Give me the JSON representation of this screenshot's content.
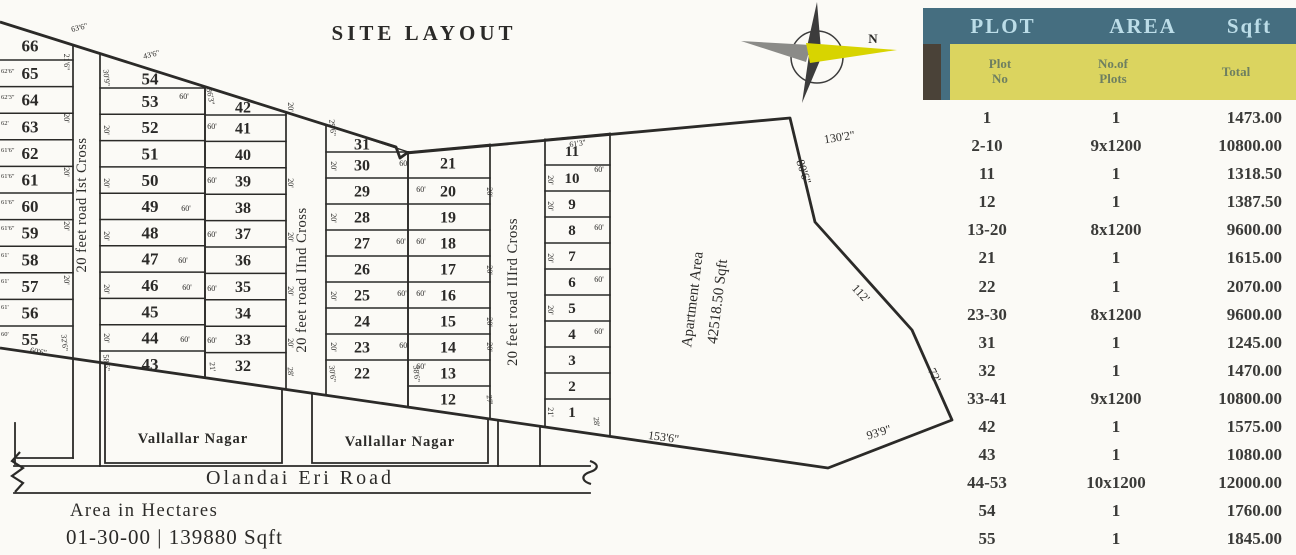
{
  "title": "SITE LAYOUT",
  "compass": {
    "north_label": "N"
  },
  "colors": {
    "ink": "#2b2a28",
    "paper": "#fbfaf6",
    "teal": "#456e80",
    "teal_text": "#bcdde8",
    "yellow": "#dbd45f",
    "yellow_text": "#6e7f60",
    "brown": "#4a4238",
    "row_text": "#3a3a38",
    "compass_dark": "#3c3c3c",
    "compass_gray": "#8b8b88",
    "compass_yellow": "#d8d400"
  },
  "site": {
    "columns": [
      {
        "x": 0,
        "w": 73,
        "div0": 60,
        "row_h": 26.6,
        "fs": 17,
        "num_x": 30,
        "plots": [
          "66",
          "65",
          "64",
          "63",
          "62",
          "61",
          "60",
          "59",
          "58",
          "57",
          "56",
          "55"
        ]
      },
      {
        "x": 100,
        "w": 105,
        "div0": 88,
        "row_h": 26.3,
        "fs": 17,
        "num_x": 150,
        "plots": [
          "54",
          "53",
          "52",
          "51",
          "50",
          "49",
          "48",
          "47",
          "46",
          "45",
          "44",
          "43"
        ]
      },
      {
        "x": 205,
        "w": 81,
        "div0": 115,
        "row_h": 26.4,
        "fs": 16,
        "num_x": 243,
        "plots": [
          "42",
          "41",
          "40",
          "39",
          "38",
          "37",
          "36",
          "35",
          "34",
          "33",
          "32"
        ]
      },
      {
        "x": 326,
        "w": 82,
        "div0": 152,
        "row_h": 26,
        "fs": 16,
        "num_x": 362,
        "plots": [
          "31",
          "30",
          "29",
          "28",
          "27",
          "26",
          "25",
          "24",
          "23",
          "22"
        ]
      },
      {
        "x": 408,
        "w": 82,
        "div0": 178,
        "row_h": 26,
        "fs": 16,
        "num_x": 448,
        "plots": [
          "21",
          "20",
          "19",
          "18",
          "17",
          "16",
          "15",
          "14",
          "13",
          "12"
        ]
      },
      {
        "x": 545,
        "w": 65,
        "div0": 165,
        "row_h": 26,
        "fs": 15,
        "num_x": 572,
        "plots": [
          "11",
          "10",
          "9",
          "8",
          "7",
          "6",
          "5",
          "4",
          "3",
          "2",
          "1"
        ]
      }
    ],
    "roads_vertical": [
      {
        "label": "20 feet road Ist Cross",
        "x": 86,
        "y": 205
      },
      {
        "label": "20 feet road IInd Cross",
        "x": 306,
        "y": 280
      },
      {
        "label": "20 feet road IIIrd Cross",
        "x": 517,
        "y": 292
      }
    ],
    "bottom_road": {
      "label": "Olandai Eri Road",
      "x": 300,
      "y": 484
    },
    "nagar_boxes": [
      {
        "label": "Vallallar Nagar",
        "points": "105,363 282,389 282,463 105,463",
        "lx": 193,
        "ly": 443
      },
      {
        "label": "Vallallar Nagar",
        "points": "312,393 488,419 488,463 312,463",
        "lx": 400,
        "ly": 446
      }
    ],
    "apartment": {
      "line1": "Apartment Area",
      "line2": "42518.50 Sqft",
      "x1": 697,
      "y1": 300,
      "x2": 722,
      "y2": 302,
      "rot": -83
    },
    "boundary_points": "0,22 396,147 400,158 407,153 790,118 815,222 912,330 952,420 828,468 0,348",
    "extra_lines": [
      [
        73,
        359,
        73,
        458
      ],
      [
        100,
        362,
        100,
        466
      ],
      [
        15,
        423,
        15,
        464
      ],
      [
        17,
        458,
        73,
        458
      ],
      [
        498,
        420,
        498,
        466
      ],
      [
        540,
        426,
        540,
        466
      ],
      [
        14,
        466,
        590,
        466
      ],
      [
        14,
        493,
        590,
        493
      ]
    ],
    "end_marks": [
      "M20,452 l-8,9 11,7 -11,8 11,7 -8,9",
      "M590,461 c9,3 9,8 0,11 c-9,3 -9,9 1,12"
    ],
    "boundary_dims": [
      {
        "t": "130'2\"",
        "x": 840,
        "y": 141,
        "r": -9
      },
      {
        "t": "80'6\"",
        "x": 800,
        "y": 173,
        "r": 72
      },
      {
        "t": "112'",
        "x": 858,
        "y": 296,
        "r": 47
      },
      {
        "t": "72'",
        "x": 931,
        "y": 377,
        "r": 63
      },
      {
        "t": "93'9\"",
        "x": 880,
        "y": 436,
        "r": -17
      },
      {
        "t": "153'6\"",
        "x": 663,
        "y": 441,
        "r": 8
      }
    ],
    "dim_labels": [
      {
        "t": "63'6\"",
        "x": 80,
        "y": 30,
        "r": -14
      },
      {
        "t": "43'6\"",
        "x": 152,
        "y": 57,
        "r": -14
      },
      {
        "t": "61'3\"",
        "x": 578,
        "y": 146,
        "r": -8
      },
      {
        "t": "36'3\"",
        "x": 208,
        "y": 97,
        "r": 80
      },
      {
        "t": "29'6\"",
        "x": 330,
        "y": 128,
        "r": 85
      },
      {
        "t": "21'6\"",
        "x": 64,
        "y": 62,
        "r": 90
      },
      {
        "t": "20'",
        "x": 64,
        "y": 118,
        "r": 90
      },
      {
        "t": "20'",
        "x": 64,
        "y": 172,
        "r": 90
      },
      {
        "t": "20'",
        "x": 64,
        "y": 226,
        "r": 90
      },
      {
        "t": "20'",
        "x": 64,
        "y": 280,
        "r": 90
      },
      {
        "t": "32'6\"",
        "x": 62,
        "y": 343,
        "r": 85
      },
      {
        "t": "60'6\"",
        "x": 38,
        "y": 354,
        "r": 10
      },
      {
        "t": "30'9\"",
        "x": 104,
        "y": 78,
        "r": 85
      },
      {
        "t": "20'",
        "x": 104,
        "y": 130,
        "r": 90
      },
      {
        "t": "20'",
        "x": 104,
        "y": 183,
        "r": 90
      },
      {
        "t": "20'",
        "x": 104,
        "y": 236,
        "r": 90
      },
      {
        "t": "20'",
        "x": 104,
        "y": 289,
        "r": 90
      },
      {
        "t": "20'",
        "x": 104,
        "y": 338,
        "r": 90
      },
      {
        "t": "58'6\"",
        "x": 104,
        "y": 363,
        "r": 85
      },
      {
        "t": "60'",
        "x": 184,
        "y": 99
      },
      {
        "t": "60'",
        "x": 186,
        "y": 211
      },
      {
        "t": "60'",
        "x": 183,
        "y": 263
      },
      {
        "t": "60'",
        "x": 187,
        "y": 290
      },
      {
        "t": "60'",
        "x": 185,
        "y": 342
      },
      {
        "t": "21'",
        "x": 210,
        "y": 367,
        "r": 85
      },
      {
        "t": "60'",
        "x": 212,
        "y": 129
      },
      {
        "t": "60'",
        "x": 212,
        "y": 183
      },
      {
        "t": "60'",
        "x": 212,
        "y": 237
      },
      {
        "t": "60'",
        "x": 212,
        "y": 291
      },
      {
        "t": "60'",
        "x": 212,
        "y": 343
      },
      {
        "t": "20'",
        "x": 288,
        "y": 107,
        "r": 90
      },
      {
        "t": "20'",
        "x": 288,
        "y": 183,
        "r": 90
      },
      {
        "t": "20'",
        "x": 288,
        "y": 237,
        "r": 90
      },
      {
        "t": "20'",
        "x": 288,
        "y": 291,
        "r": 90
      },
      {
        "t": "20'",
        "x": 288,
        "y": 343,
        "r": 90
      },
      {
        "t": "28'",
        "x": 288,
        "y": 372,
        "r": 85
      },
      {
        "t": "20'",
        "x": 331,
        "y": 166,
        "r": 90
      },
      {
        "t": "20'",
        "x": 331,
        "y": 218,
        "r": 90
      },
      {
        "t": "20'",
        "x": 331,
        "y": 296,
        "r": 90
      },
      {
        "t": "20'",
        "x": 331,
        "y": 347,
        "r": 90
      },
      {
        "t": "30'6\"",
        "x": 330,
        "y": 374,
        "r": 85
      },
      {
        "t": "60'",
        "x": 404,
        "y": 166
      },
      {
        "t": "60'",
        "x": 401,
        "y": 244
      },
      {
        "t": "60'",
        "x": 402,
        "y": 296
      },
      {
        "t": "60'",
        "x": 404,
        "y": 348
      },
      {
        "t": "38'6\"",
        "x": 414,
        "y": 374,
        "r": 85
      },
      {
        "t": "60'",
        "x": 421,
        "y": 192
      },
      {
        "t": "60'",
        "x": 421,
        "y": 244
      },
      {
        "t": "60'",
        "x": 421,
        "y": 296
      },
      {
        "t": "60'",
        "x": 421,
        "y": 369
      },
      {
        "t": "20'",
        "x": 487,
        "y": 192,
        "r": 90
      },
      {
        "t": "20'",
        "x": 487,
        "y": 270,
        "r": 90
      },
      {
        "t": "20'",
        "x": 487,
        "y": 322,
        "r": 90
      },
      {
        "t": "20'",
        "x": 487,
        "y": 347,
        "r": 90
      },
      {
        "t": "27'",
        "x": 487,
        "y": 400,
        "r": 85
      },
      {
        "t": "20'",
        "x": 548,
        "y": 180,
        "r": 90
      },
      {
        "t": "20'",
        "x": 548,
        "y": 206,
        "r": 90
      },
      {
        "t": "20'",
        "x": 548,
        "y": 258,
        "r": 90
      },
      {
        "t": "20'",
        "x": 548,
        "y": 310,
        "r": 90
      },
      {
        "t": "21'",
        "x": 548,
        "y": 412,
        "r": 90
      },
      {
        "t": "60'",
        "x": 599,
        "y": 172
      },
      {
        "t": "60'",
        "x": 599,
        "y": 230
      },
      {
        "t": "60'",
        "x": 599,
        "y": 282
      },
      {
        "t": "60'",
        "x": 599,
        "y": 334
      },
      {
        "t": "28'",
        "x": 594,
        "y": 422,
        "r": 85
      }
    ],
    "edge_labels": [
      {
        "t": "62'6\"",
        "y": 73
      },
      {
        "t": "62'3\"",
        "y": 99
      },
      {
        "t": "62'",
        "y": 125
      },
      {
        "t": "61'6\"",
        "y": 152
      },
      {
        "t": "61'6\"",
        "y": 178
      },
      {
        "t": "61'6\"",
        "y": 204
      },
      {
        "t": "61'6\"",
        "y": 230
      },
      {
        "t": "61'",
        "y": 257
      },
      {
        "t": "61'",
        "y": 283
      },
      {
        "t": "61'",
        "y": 309
      },
      {
        "t": "60'",
        "y": 336
      }
    ],
    "notes": [
      "Area in Hectares",
      "01-30-00 | 139880 Sqft"
    ]
  },
  "table": {
    "header": [
      "PLOT",
      "AREA",
      "Sqft"
    ],
    "subheader": [
      "Plot\nNo",
      "No.of\nPlots",
      "Total"
    ],
    "rows": [
      [
        "1",
        "1",
        "1473.00"
      ],
      [
        "2-10",
        "9x1200",
        "10800.00"
      ],
      [
        "11",
        "1",
        "1318.50"
      ],
      [
        "12",
        "1",
        "1387.50"
      ],
      [
        "13-20",
        "8x1200",
        "9600.00"
      ],
      [
        "21",
        "1",
        "1615.00"
      ],
      [
        "22",
        "1",
        "2070.00"
      ],
      [
        "23-30",
        "8x1200",
        "9600.00"
      ],
      [
        "31",
        "1",
        "1245.00"
      ],
      [
        "32",
        "1",
        "1470.00"
      ],
      [
        "33-41",
        "9x1200",
        "10800.00"
      ],
      [
        "42",
        "1",
        "1575.00"
      ],
      [
        "43",
        "1",
        "1080.00"
      ],
      [
        "44-53",
        "10x1200",
        "12000.00"
      ],
      [
        "54",
        "1",
        "1760.00"
      ],
      [
        "55",
        "1",
        "1845.00"
      ]
    ]
  }
}
